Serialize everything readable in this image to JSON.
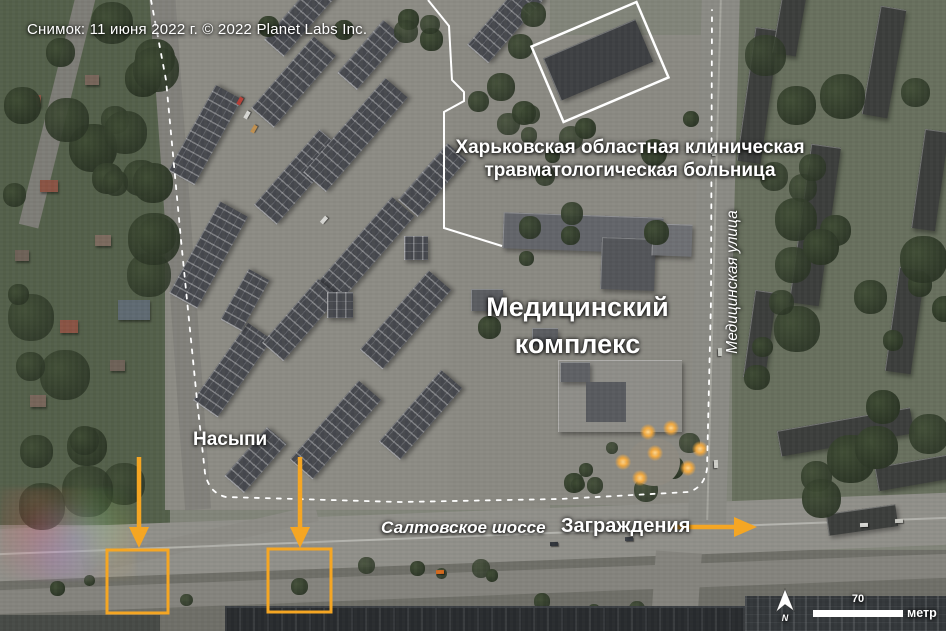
{
  "credit": "Снимок: 11 июня 2022 г. © 2022 Planet Labs Inc.",
  "hospital": {
    "line1": "Харьковская областная клиническая",
    "line2": "травматологическая больница"
  },
  "complex": {
    "line1": "Медицинский",
    "line2": "комплекс"
  },
  "street_label": "Медицинская улица",
  "embankments_label": "Насыпи",
  "highway_label": "Салтовское шоссе",
  "barriers_label": "Заграждения",
  "scale_bar": {
    "value": "70",
    "unit": "метр"
  },
  "compass": {
    "north": "N"
  },
  "colors": {
    "annotation_orange": "#F5A623",
    "annotation_white": "#FFFFFF"
  }
}
